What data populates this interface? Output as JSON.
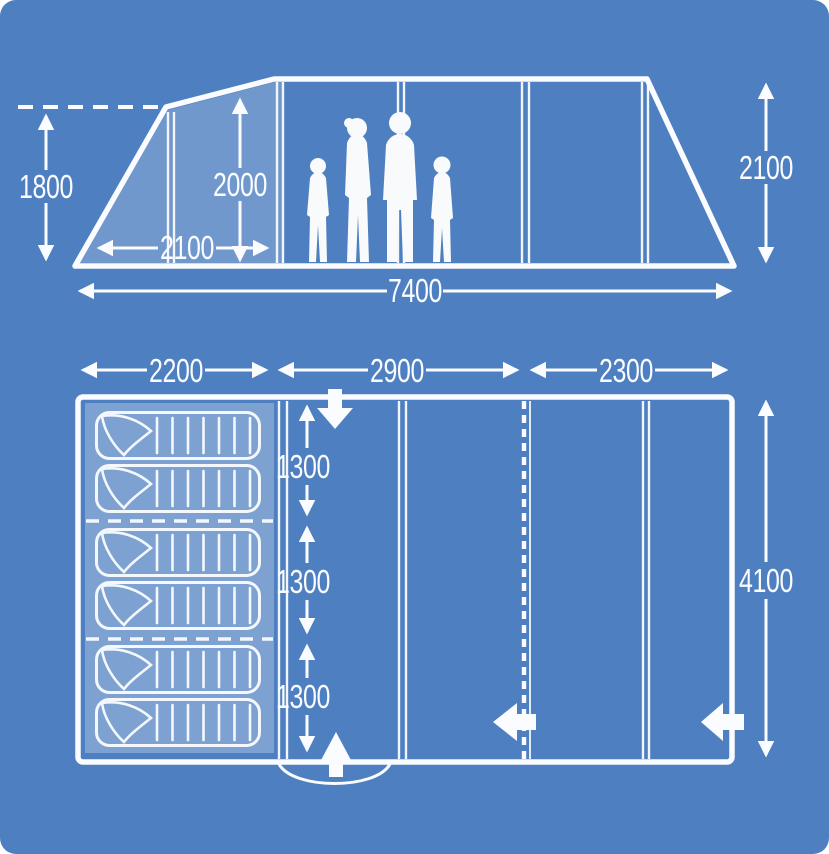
{
  "diagram_title": "tent-dimensions-diagram",
  "side_view": {
    "porch_height_mm": "1800",
    "peak_height_mm": "2000",
    "porch_depth_mm": "2100",
    "total_length_mm": "7400",
    "rear_height_mm": "2100"
  },
  "floor_plan": {
    "bedroom_width_mm": "2200",
    "living_width_mm": "2900",
    "front_width_mm": "2300",
    "berth_depth_mm": [
      "1300",
      "1300",
      "1300"
    ],
    "total_depth_mm": "4100",
    "berth_count": 6
  },
  "icons": {
    "family_silhouette": "four-person-family",
    "front_entrance": "block-arrow-down",
    "rear_entrance": "block-arrow-up",
    "inner_door": "block-arrow-left",
    "side_door": "block-arrow-left"
  },
  "colors": {
    "background": "#4E7FC0",
    "line": "#FAFCFF",
    "panel_overlay": "rgba(255,255,255,0.20)",
    "bedroom_overlay": "rgba(255,255,255,0.27)"
  }
}
